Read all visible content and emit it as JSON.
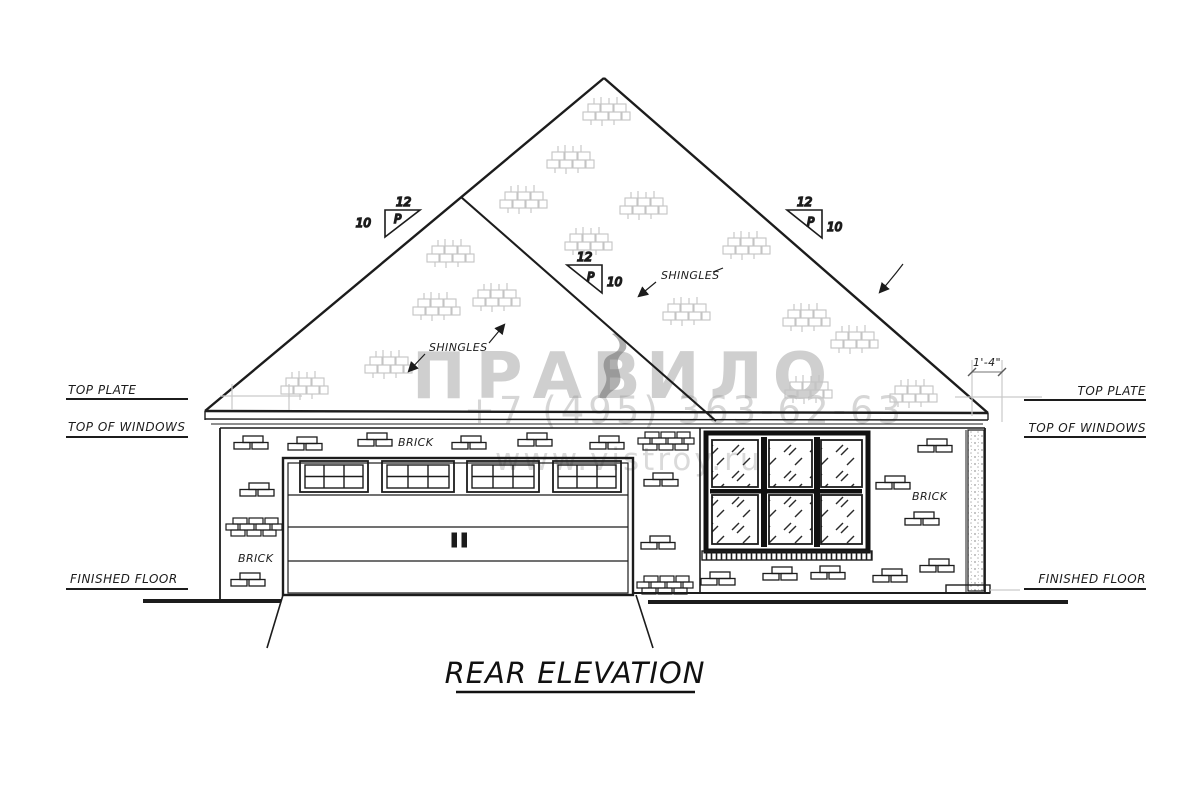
{
  "drawing": {
    "title": "REAR ELEVATION",
    "labels": {
      "top_plate": "TOP PLATE",
      "top_of_windows": "TOP OF WINDOWS",
      "finished_floor": "FINISHED FLOOR",
      "brick": "BRICK",
      "shingles": "SHINGLES"
    },
    "pitch": {
      "run": "12",
      "rise": "10",
      "letter": "P"
    },
    "dimensions": {
      "eave_overhang": "1'-4\""
    },
    "colors": {
      "line": "#1c1c1c",
      "shingle_gray": "#c4c4c4",
      "construction_gray": "#c9c9c9",
      "watermark_gray": "#9a9a9a"
    }
  },
  "watermark": {
    "brand_left": "ПРАВ",
    "brand_right": "ИЛО",
    "symbol": "figure-ornament",
    "phone": "+7 (495) 363-62-63",
    "site": "www.vistroy.ru"
  }
}
